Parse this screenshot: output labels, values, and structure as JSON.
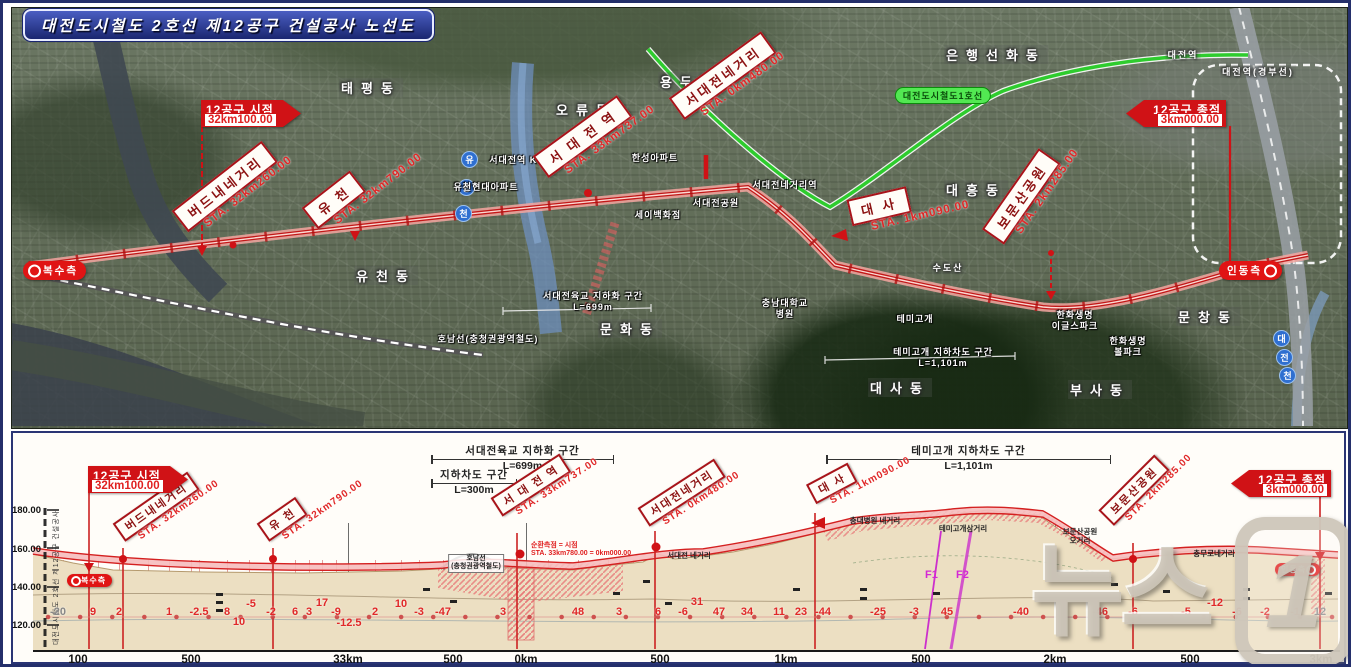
{
  "title": "대전도시철도 2호선 제12공구 건설공사 노선도",
  "watermark": {
    "text": "뉴스",
    "badge": "1"
  },
  "colors": {
    "callout_border": "#a8141a",
    "sta_red": "#e02828",
    "flag_red": "#d01216",
    "route_red": "#c41a1a",
    "line1_green": "#2ecc2e",
    "pill_red": "#e01414",
    "terrain_tan": "#ecdfc2",
    "fault_magenta": "#cc2fcc"
  },
  "map": {
    "area_labels": [
      {
        "text": "태평동",
        "x": 368,
        "y": 75
      },
      {
        "text": "오류동",
        "x": 583,
        "y": 97
      },
      {
        "text": "용두동",
        "x": 687,
        "y": 69
      },
      {
        "text": "은행선화동",
        "x": 993,
        "y": 42
      },
      {
        "text": "대전역",
        "x": 1180,
        "y": 45,
        "cls": "sm"
      },
      {
        "text": "대전역(경부선)",
        "x": 1255,
        "y": 62,
        "cls": "sm"
      },
      {
        "text": "대흥동",
        "x": 973,
        "y": 177
      },
      {
        "text": "유천동",
        "x": 383,
        "y": 263
      },
      {
        "text": "문화동",
        "x": 627,
        "y": 316
      },
      {
        "text": "대사동",
        "x": 897,
        "y": 375
      },
      {
        "text": "문창동",
        "x": 1205,
        "y": 304
      },
      {
        "text": "부사동",
        "x": 1097,
        "y": 377
      },
      {
        "text": "수도산",
        "x": 945,
        "y": 258,
        "cls": "sm"
      }
    ],
    "place_labels": [
      {
        "text": "서대전역 KTX",
        "x": 517,
        "y": 152
      },
      {
        "text": "한성아파트",
        "x": 652,
        "y": 150
      },
      {
        "text": "유천현대아파트",
        "x": 483,
        "y": 179
      },
      {
        "text": "세이백화점",
        "x": 655,
        "y": 207
      },
      {
        "text": "서대전네거리역",
        "x": 782,
        "y": 177
      },
      {
        "text": "서대전공원",
        "x": 713,
        "y": 195
      },
      {
        "text": "충남대학교\n병원",
        "x": 782,
        "y": 295
      },
      {
        "text": "서대전육교 지하화 구간\nL=699m",
        "x": 590,
        "y": 288
      },
      {
        "text": "호남선(충청권광역철도)",
        "x": 485,
        "y": 331
      },
      {
        "text": "테미고개",
        "x": 912,
        "y": 311
      },
      {
        "text": "테미고개 지하차도 구간\nL=1,101m",
        "x": 940,
        "y": 344
      },
      {
        "text": "한화생명\n이글스파크",
        "x": 1072,
        "y": 307
      },
      {
        "text": "한화생명\n볼파크",
        "x": 1125,
        "y": 333
      }
    ],
    "line1_label": {
      "text": "대전도시철도1호선",
      "x": 940,
      "y": 84
    },
    "callouts": [
      {
        "name": "버드내네거리",
        "sta": "STA. 32km260.00",
        "x": 192,
        "y": 200,
        "rot": -38
      },
      {
        "name": "유  천",
        "sta": "STA. 32km790.00",
        "x": 322,
        "y": 197,
        "rot": -38
      },
      {
        "name": "서 대 전 역",
        "sta": "STA. 33km737.00",
        "x": 552,
        "y": 146,
        "rot": -36
      },
      {
        "name": "서대전네거리",
        "sta": "STA. 0km480.00",
        "x": 688,
        "y": 88,
        "rot": -36
      },
      {
        "name": "대      사",
        "sta": "STA. 1km090.00",
        "x": 852,
        "y": 196,
        "rot": -13
      },
      {
        "name": "보문산공원",
        "sta": "STA. 2km285.00",
        "x": 1010,
        "y": 210,
        "rot": -55
      }
    ],
    "flags": [
      {
        "title": "12공구 시점",
        "value": "32km100.00",
        "x": 198,
        "y": 97
      },
      {
        "title": "12공구 종점",
        "value": "3km000.00",
        "x": 1123,
        "y": 97,
        "cls": "left"
      }
    ],
    "pills": [
      {
        "text": "복수측",
        "x": 20,
        "y": 258
      },
      {
        "text": "인동측",
        "x": 1216,
        "y": 258,
        "cls": "right"
      }
    ],
    "river_chars": [
      {
        "text": "유",
        "x": 458,
        "y": 148
      },
      {
        "text": "등",
        "x": 455,
        "y": 176
      },
      {
        "text": "천",
        "x": 452,
        "y": 202
      },
      {
        "text": "대",
        "x": 1270,
        "y": 327
      },
      {
        "text": "전",
        "x": 1273,
        "y": 346
      },
      {
        "text": "천",
        "x": 1276,
        "y": 364
      }
    ]
  },
  "profile": {
    "axis_caption": "대전도시철도 2호선 제12공구 건설공사",
    "y_ticks": [
      {
        "label": "180.00",
        "y": 502
      },
      {
        "label": "160.00",
        "y": 541
      },
      {
        "label": "140.00",
        "y": 579
      },
      {
        "label": "120.00",
        "y": 617
      }
    ],
    "x_ticks": [
      {
        "label": "100",
        "x": 75
      },
      {
        "label": "500",
        "x": 188
      },
      {
        "label": "33km",
        "x": 345
      },
      {
        "label": "500",
        "x": 450
      },
      {
        "label": "0km",
        "x": 523
      },
      {
        "label": "500",
        "x": 657
      },
      {
        "label": "1km",
        "x": 783
      },
      {
        "label": "500",
        "x": 918
      },
      {
        "label": "2km",
        "x": 1052
      },
      {
        "label": "500",
        "x": 1187
      },
      {
        "label": "3km",
        "x": 1318
      }
    ],
    "grades": [
      {
        "v": "-20",
        "x": 55,
        "cls": "gray"
      },
      {
        "v": "9",
        "x": 90
      },
      {
        "v": "2",
        "x": 116
      },
      {
        "v": "1",
        "x": 166
      },
      {
        "v": "-2.5",
        "x": 196
      },
      {
        "v": "8",
        "x": 224
      },
      {
        "v": "10",
        "x": 236,
        "y": 619
      },
      {
        "v": "-5",
        "x": 248,
        "y": 601
      },
      {
        "v": "-2",
        "x": 268
      },
      {
        "v": "6",
        "x": 292
      },
      {
        "v": "3",
        "x": 306
      },
      {
        "v": "17",
        "x": 319,
        "y": 600
      },
      {
        "v": "-9",
        "x": 333
      },
      {
        "v": "-12.5",
        "x": 346,
        "y": 620
      },
      {
        "v": "2",
        "x": 372
      },
      {
        "v": "10",
        "x": 398,
        "y": 601
      },
      {
        "v": "-3",
        "x": 416
      },
      {
        "v": "-47",
        "x": 440
      },
      {
        "v": "3",
        "x": 500
      },
      {
        "v": "48",
        "x": 575
      },
      {
        "v": "3",
        "x": 616
      },
      {
        "v": "6",
        "x": 655
      },
      {
        "v": "-6",
        "x": 680
      },
      {
        "v": "31",
        "x": 694,
        "y": 599
      },
      {
        "v": "47",
        "x": 716
      },
      {
        "v": "34",
        "x": 744
      },
      {
        "v": "11",
        "x": 776
      },
      {
        "v": "23",
        "x": 798
      },
      {
        "v": "-44",
        "x": 820
      },
      {
        "v": "-25",
        "x": 875
      },
      {
        "v": "-3",
        "x": 911
      },
      {
        "v": "45",
        "x": 944
      },
      {
        "v": "-40",
        "x": 1018
      },
      {
        "v": "-46",
        "x": 1097
      },
      {
        "v": "-6",
        "x": 1130
      },
      {
        "v": "-5",
        "x": 1183
      },
      {
        "v": "-12",
        "x": 1212,
        "y": 600
      },
      {
        "v": "-6",
        "x": 1234
      },
      {
        "v": "-2",
        "x": 1262
      },
      {
        "v": "-1",
        "x": 1292
      },
      {
        "v": "12",
        "x": 1317,
        "cls": "gray"
      }
    ],
    "callouts": [
      {
        "name": "버드내네거리",
        "sta": "STA. 32km260.00",
        "x": 128,
        "y": 515,
        "rot": -35
      },
      {
        "name": "유  천",
        "sta": "STA. 32km790.00",
        "x": 272,
        "y": 515,
        "rot": -35
      },
      {
        "name": "서 대 전 역",
        "sta": "STA. 33km737.00",
        "x": 505,
        "y": 490,
        "rot": -33
      },
      {
        "name": "서대전네거리",
        "sta": "STA. 0km480.00",
        "x": 652,
        "y": 500,
        "rot": -33
      },
      {
        "name": "대      사",
        "sta": "STA. 1km090.00",
        "x": 818,
        "y": 478,
        "rot": -28
      },
      {
        "name": "보문산공원",
        "sta": "STA. 2km285.00",
        "x": 1118,
        "y": 498,
        "rot": -45
      }
    ],
    "flags": [
      {
        "title": "12공구 시점",
        "value": "32km100.00",
        "x": 85,
        "y": 463
      },
      {
        "title": "12공구 종점",
        "value": "3km000.00",
        "x": 1228,
        "y": 467,
        "cls": "left"
      }
    ],
    "pills": [
      {
        "text": "복수측",
        "x": 64,
        "y": 571,
        "cls": "sm"
      },
      {
        "text": "인동측",
        "x": 1272,
        "y": 560,
        "cls": "sm right"
      }
    ],
    "brackets": [
      {
        "label": "서대전육교 지하화 구간",
        "sub": "L=699m",
        "x": 428,
        "w": 183,
        "y": 440
      },
      {
        "label": "지하차도 구간",
        "sub": "L=300m",
        "x": 428,
        "w": 86,
        "y": 464
      },
      {
        "label": "테미고개 지하차도 구간",
        "sub": "L=1,101m",
        "x": 823,
        "w": 285,
        "y": 440
      }
    ],
    "small_labels": [
      {
        "text": "호남선\n(충청권광역철도)",
        "x": 473,
        "y": 551,
        "cls": "boxed"
      },
      {
        "text": "순환측점 = 시점\nSTA. 33km780.00 = 0km000.00",
        "x": 528,
        "y": 539,
        "cls": "red"
      },
      {
        "text": "서대전 네거리",
        "x": 686,
        "y": 548
      },
      {
        "text": "충대병원 네거리",
        "x": 872,
        "y": 513
      },
      {
        "text": "테미고개삼거리",
        "x": 960,
        "y": 521
      },
      {
        "text": "보문산공원\n오거리",
        "x": 1077,
        "y": 524
      },
      {
        "text": "충무로네거리",
        "x": 1211,
        "y": 546
      }
    ],
    "faults": [
      {
        "text": "F1",
        "x": 922,
        "y": 566
      },
      {
        "text": "F2",
        "x": 953,
        "y": 566
      }
    ],
    "gridlines": [
      {
        "x": 60
      },
      {
        "x": 95
      },
      {
        "x": 116
      },
      {
        "x": 145
      },
      {
        "x": 166
      },
      {
        "x": 188
      },
      {
        "x": 196
      },
      {
        "x": 224
      },
      {
        "x": 246
      },
      {
        "x": 268
      },
      {
        "x": 292
      },
      {
        "x": 306
      },
      {
        "x": 319
      },
      {
        "x": 333
      },
      {
        "x": 345,
        "cls": "dark"
      },
      {
        "x": 372
      },
      {
        "x": 398
      },
      {
        "x": 416
      },
      {
        "x": 440
      },
      {
        "x": 470
      },
      {
        "x": 500
      },
      {
        "x": 523,
        "cls": "dark"
      },
      {
        "x": 545
      },
      {
        "x": 575
      },
      {
        "x": 605
      },
      {
        "x": 616
      },
      {
        "x": 630
      },
      {
        "x": 668
      },
      {
        "x": 680
      },
      {
        "x": 694
      },
      {
        "x": 716
      },
      {
        "x": 744
      },
      {
        "x": 776
      },
      {
        "x": 798
      },
      {
        "x": 820
      },
      {
        "x": 845
      },
      {
        "x": 875
      },
      {
        "x": 890
      },
      {
        "x": 911
      },
      {
        "x": 930
      },
      {
        "x": 944
      },
      {
        "x": 960
      },
      {
        "x": 975
      },
      {
        "x": 990
      },
      {
        "x": 1018
      },
      {
        "x": 1035
      },
      {
        "x": 1052,
        "cls": "dark"
      },
      {
        "x": 1065
      },
      {
        "x": 1080
      },
      {
        "x": 1097
      },
      {
        "x": 1115
      },
      {
        "x": 1145
      },
      {
        "x": 1160
      },
      {
        "x": 1187
      },
      {
        "x": 1200
      },
      {
        "x": 1212
      },
      {
        "x": 1234
      },
      {
        "x": 1248
      },
      {
        "x": 1262
      },
      {
        "x": 1277
      },
      {
        "x": 1292
      },
      {
        "x": 1305
      }
    ],
    "boreholes": [
      {
        "x": 213,
        "y": 590
      },
      {
        "x": 213,
        "y": 598
      },
      {
        "x": 213,
        "y": 606
      },
      {
        "x": 420,
        "y": 585
      },
      {
        "x": 447,
        "y": 597
      },
      {
        "x": 610,
        "y": 589
      },
      {
        "x": 640,
        "y": 577
      },
      {
        "x": 662,
        "y": 599
      },
      {
        "x": 790,
        "y": 585
      },
      {
        "x": 857,
        "y": 585
      },
      {
        "x": 857,
        "y": 594
      },
      {
        "x": 930,
        "y": 589
      },
      {
        "x": 1108,
        "y": 580
      },
      {
        "x": 1160,
        "y": 587
      },
      {
        "x": 1240,
        "y": 585
      },
      {
        "x": 1240,
        "y": 594
      },
      {
        "x": 1322,
        "y": 589
      }
    ]
  }
}
